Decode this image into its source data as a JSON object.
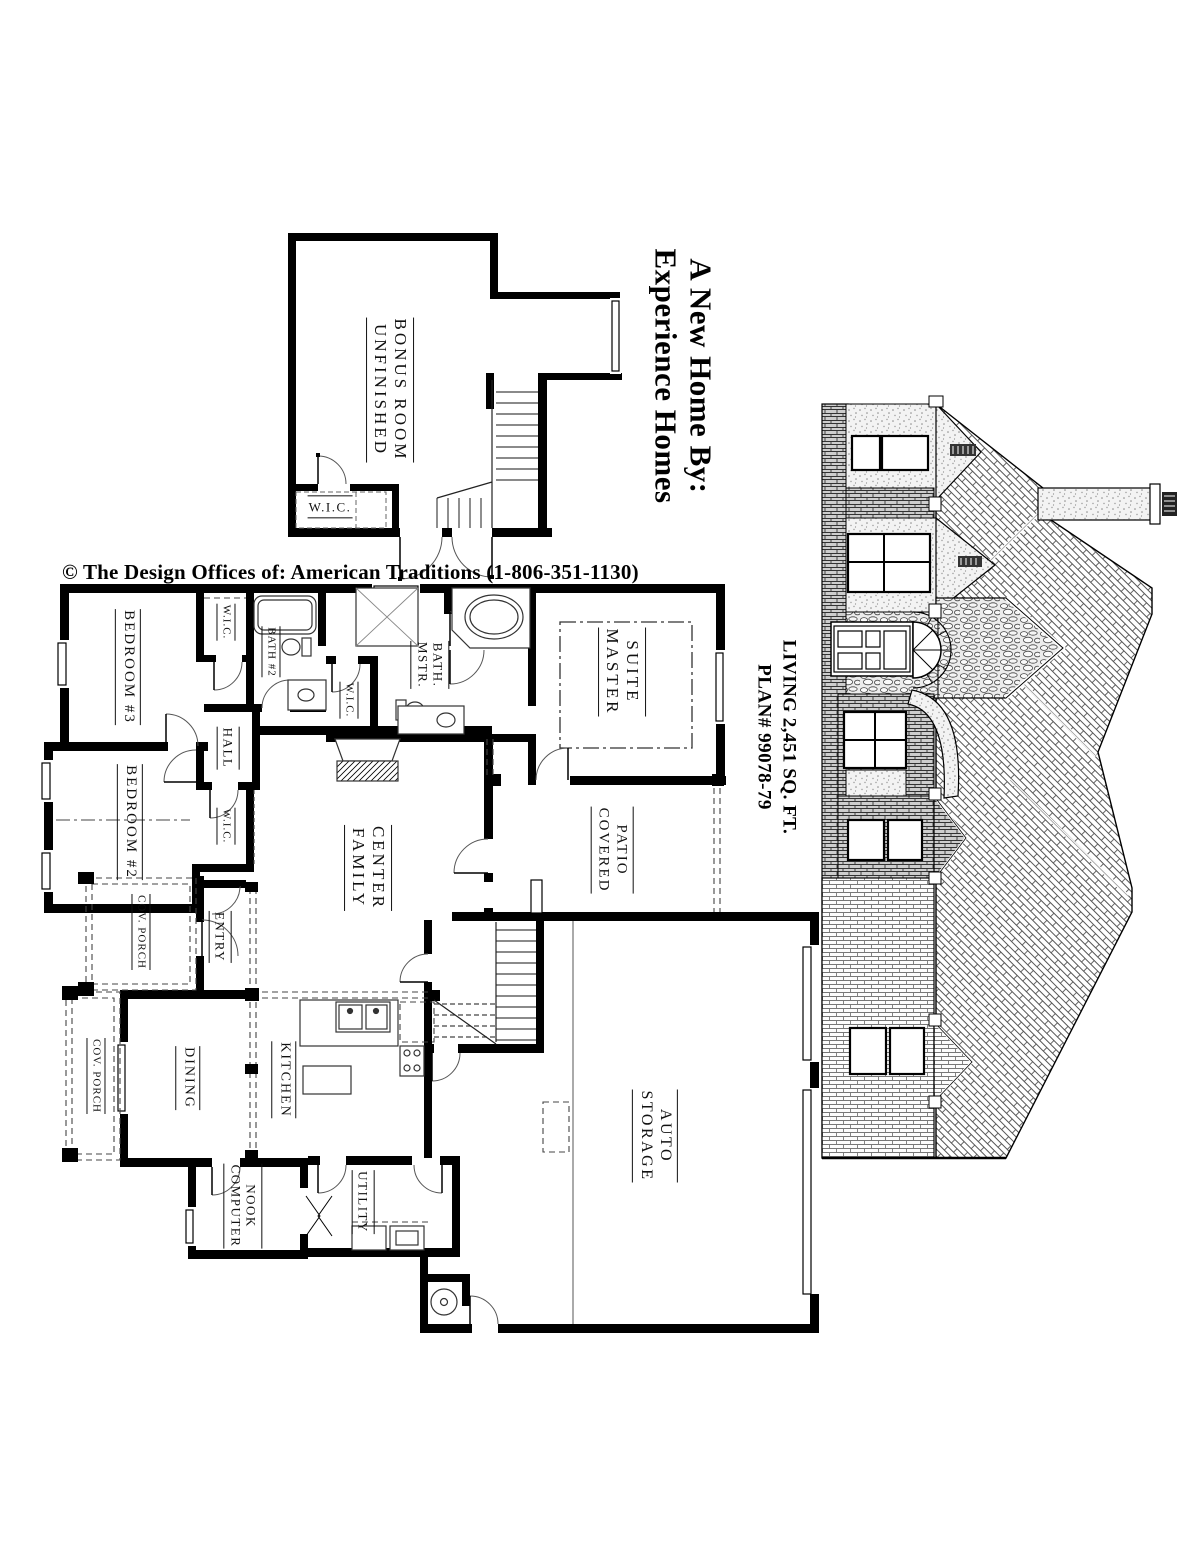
{
  "header": {
    "title_line1": "A New Home By:",
    "title_line2": "Experience Homes",
    "copyright": "© The Design Offices of: American Traditions (1-806-351-1130)"
  },
  "plan_info": {
    "living": "LIVING 2,451 SQ. FT.",
    "plan_number": "PLAN#  99078-79"
  },
  "upper_floor": {
    "bonus_room_line1": "UNFINISHED",
    "bonus_room_line2": "BONUS ROOM",
    "closet": "W.I.C."
  },
  "main_floor": {
    "bedroom3": "BEDROOM #3",
    "bedroom2": "BEDROOM #2",
    "wic_bedroom3": "W.I.C.",
    "wic_bedroom2": "W.I.C.",
    "wic_master": "W.I.C.",
    "bath2": "BATH #2",
    "hall": "HALL",
    "master_bath_line1": "MSTR.",
    "master_bath_line2": "BATH.",
    "master_suite_line1": "MASTER",
    "master_suite_line2": "SUITE",
    "family_center_line1": "FAMILY",
    "family_center_line2": "CENTER",
    "covered_patio_line1": "COVERED",
    "covered_patio_line2": "PATIO",
    "entry": "ENTRY",
    "cov_porch_front": "COV. PORCH",
    "cov_porch_side": "COV. PORCH",
    "dining": "DINING",
    "kitchen": "KITCHEN",
    "computer_nook_line1": "COMPUTER",
    "computer_nook_line2": "NOOK",
    "utility": "UTILITY",
    "auto_storage_line1": "AUTO",
    "auto_storage_line2": "STORAGE"
  },
  "colors": {
    "ink": "#000000",
    "paper": "#ffffff"
  }
}
